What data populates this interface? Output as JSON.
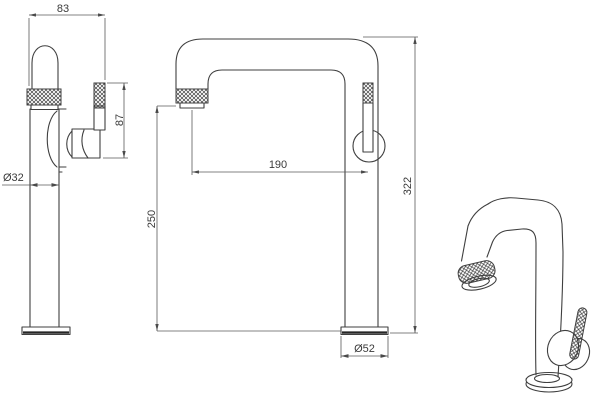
{
  "drawing": {
    "type": "technical-dimension-drawing",
    "subject": "tall single-lever mixer tap, three views",
    "background_color": "#ffffff",
    "line_color": "#3f3f3f",
    "dimension_color": "#5a5a5a",
    "side_view": {
      "overall_depth": "83",
      "handle_height": "87",
      "spout_diameter": "Ø32"
    },
    "front_view": {
      "spout_reach": "190",
      "outlet_height": "250",
      "overall_height": "322",
      "base_diameter": "Ø52"
    }
  }
}
